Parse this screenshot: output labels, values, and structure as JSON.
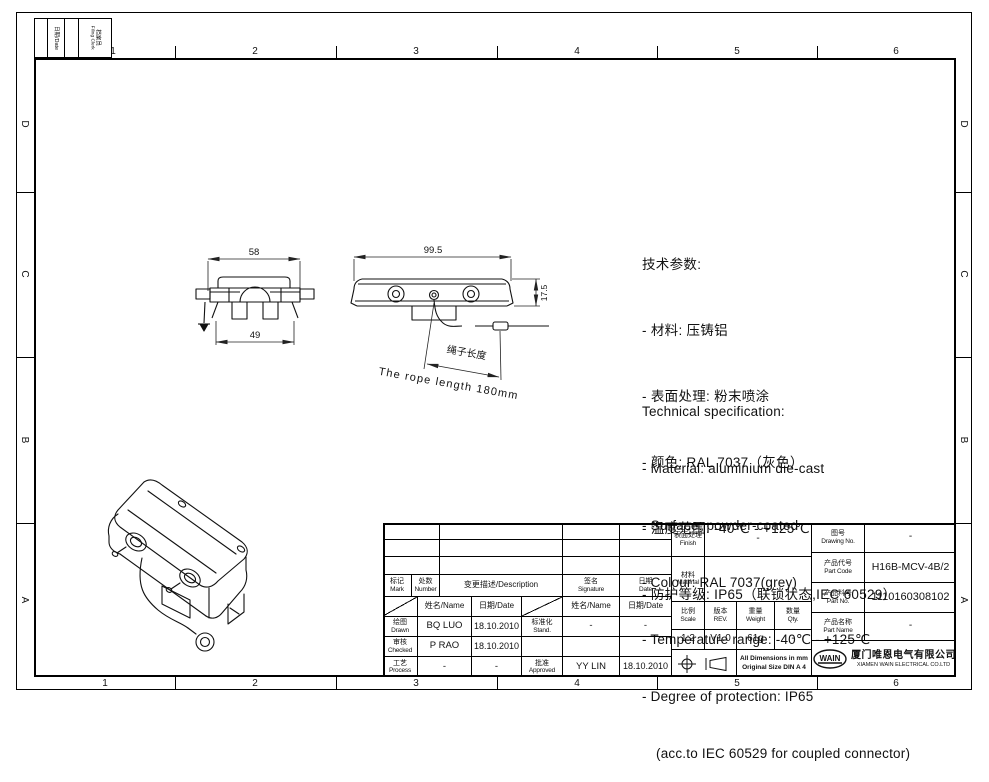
{
  "sheet": {
    "col_labels": [
      "1",
      "2",
      "3",
      "4",
      "5",
      "6"
    ],
    "row_labels": [
      "D",
      "C",
      "B",
      "A"
    ]
  },
  "corner_block": {
    "date": "日期/Date",
    "clerk_cn": "档案员",
    "clerk_en": "Filing Clerk"
  },
  "notes_cn": {
    "title": "技术参数:",
    "items": [
      "- 材料: 压铸铝",
      "- 表面处理: 粉末喷涂",
      "- 颜色: RAL 7037（灰色）",
      "- 温度范围: -40℃ - +125℃",
      "- 防护等级: IP65（联锁状态,IEC 60529）"
    ]
  },
  "notes_en": {
    "title": "Technical specification:",
    "items": [
      "- Material: aluminium die-cast",
      "- Surface: powder-coated",
      "- Colour: RAL 7037(grey)",
      "- Temperature range: -40℃ - +125℃",
      "- Degree of protection: IP65",
      "(acc.to IEC 60529 for coupled connector)"
    ]
  },
  "views": {
    "front": {
      "dim_top": "58",
      "dim_bottom": "49"
    },
    "side": {
      "dim_width": "99.5",
      "dim_height": "17.5",
      "rope_cn": "绳子长度",
      "rope_en": "The rope length 180mm"
    }
  },
  "title_block": {
    "revision_header": {
      "mark_cn": "标记",
      "mark_en": "Mark",
      "number_cn": "处数",
      "number_en": "Number",
      "description": "变更描述/Description",
      "signature_cn": "签名",
      "signature_en": "Signature",
      "date_cn": "日期",
      "date_en": "Date"
    },
    "subheader": {
      "name": "姓名/Name",
      "date": "日期/Date",
      "name2": "姓名/Name",
      "date2": "日期/Date"
    },
    "staff": {
      "drawn_cn": "绘图",
      "drawn_en": "Drawn",
      "drawn_name": "BQ LUO",
      "drawn_date": "18.10.2010",
      "checked_cn": "审核",
      "checked_en": "Checked",
      "checked_name": "P RAO",
      "checked_date": "18.10.2010",
      "process_cn": "工艺",
      "process_en": "Process",
      "process_name": "-",
      "process_date": "-",
      "stand_cn": "标准化",
      "stand_en": "Stand.",
      "stand_name": "-",
      "stand_date": "-",
      "approved_cn": "批准",
      "approved_en": "Approved",
      "approved_name": "YY LIN",
      "approved_date": "18.10.2010"
    },
    "info": {
      "finish_cn": "表面处理",
      "finish_en": "Finish",
      "finish_value": "-",
      "material_cn": "材料",
      "material_en": "Material",
      "material_value": "-",
      "scale_cn": "比例",
      "scale_en": "Scale",
      "scale_value": "1:2",
      "rev_cn": "版本",
      "rev_en": "REV.",
      "rev_value": "V1.0",
      "weight_cn": "重量",
      "weight_en": "Weight",
      "weight_value": "61g",
      "qty_cn": "数量",
      "qty_en": "Qty.",
      "qty_value": "-",
      "dims_note1": "All Dimensions in mm",
      "dims_note2": "Original Size DIN A 4"
    },
    "ids": {
      "drawing_no_cn": "图号",
      "drawing_no_en": "Drawing No.",
      "drawing_no_value": "-",
      "part_code_cn": "产品代号",
      "part_code_en": "Part Code",
      "part_code_value": "H16B-MCV-4B/2",
      "part_no_cn": "产品料号",
      "part_no_en": "Part No.",
      "part_no_value": "1110160308102",
      "part_name_cn": "产品名称",
      "part_name_en": "Part Name",
      "part_name_value": "-"
    },
    "company": {
      "logo": "WAIN",
      "name_cn": "厦门唯恩电气有限公司",
      "name_en": "XIAMEN WAIN ELECTRICAL CO.LTD"
    }
  }
}
